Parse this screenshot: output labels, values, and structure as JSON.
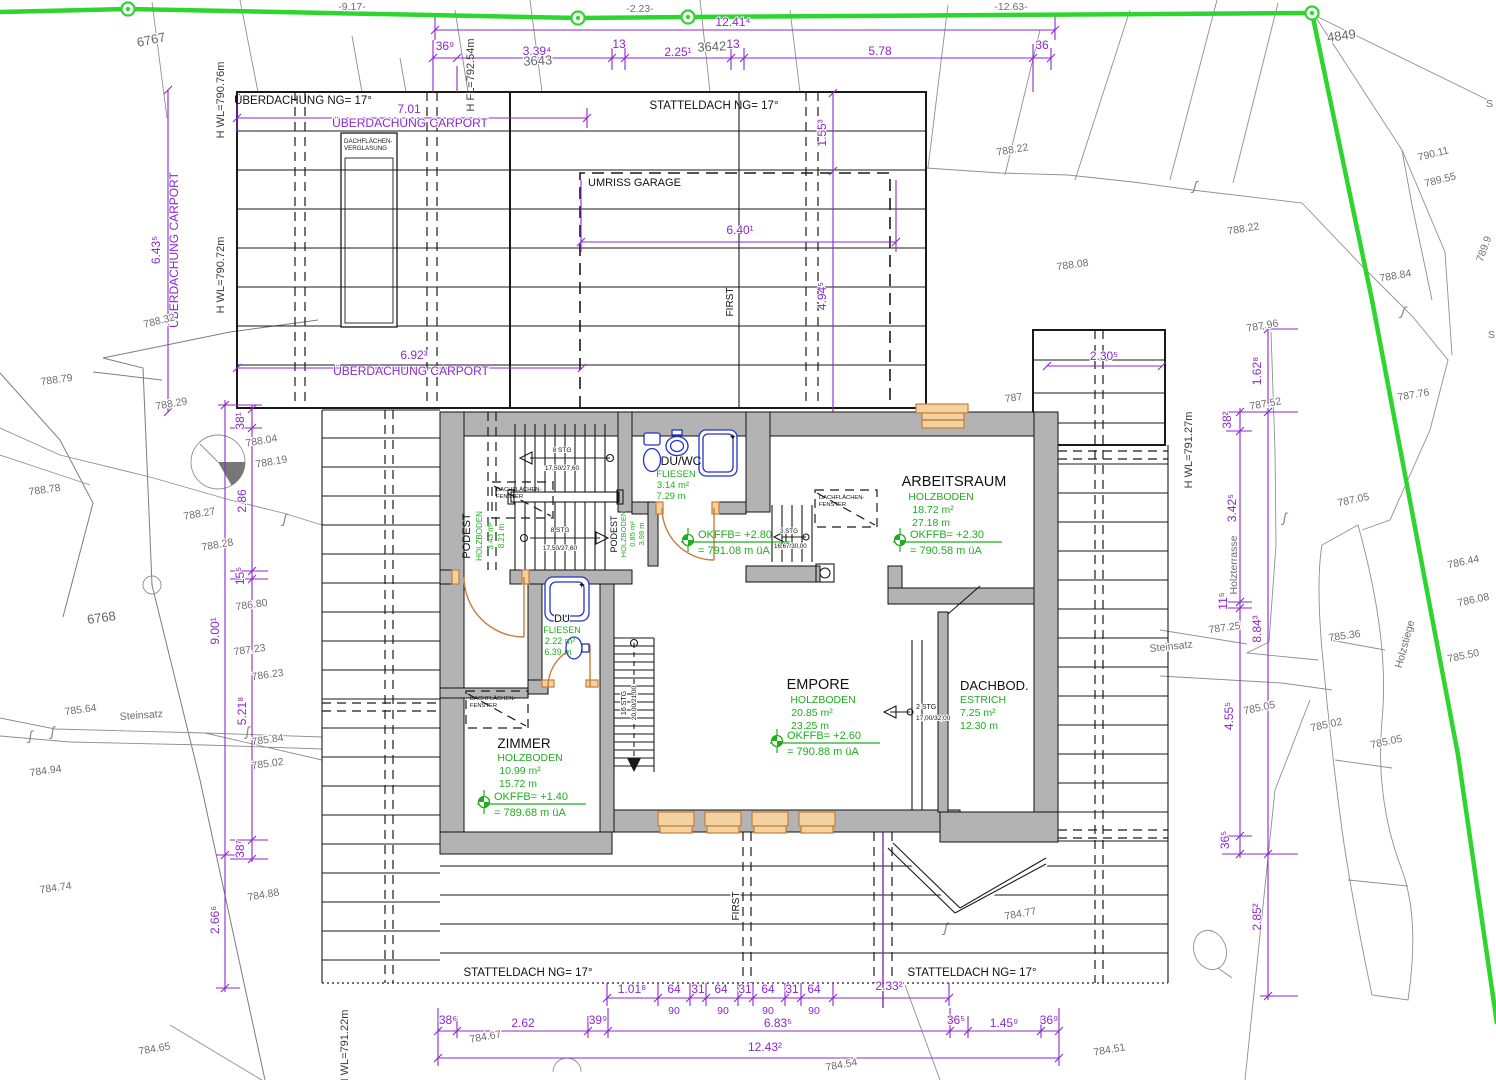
{
  "colors": {
    "dimension": "#8b28cc",
    "green_label": "#1fae1f",
    "boundary_green": "#2ed52e",
    "wall_gray": "#b3b3b3",
    "fixture_blue": "#2233cc",
    "door_orange": "#c87c3a",
    "survey_gray": "#8a8a8a"
  },
  "boundary": {
    "neg_917": "-9.17-",
    "neg_223": "-2.23-",
    "neg_1263": "-12.63-"
  },
  "parcels": {
    "p6767": "6767",
    "p3642": "3642",
    "p3643": "3643",
    "p4849": "4849",
    "p6768": "6768"
  },
  "hmarks": {
    "wl_79076": "H WL=790.76m",
    "fl_79254": "H FL=792.54m",
    "wl_79072": "H WL=790.72m",
    "wl_79127": "H WL=791.27m",
    "wl_79122": "H WL=791.22m"
  },
  "carport": {
    "title": "ÜBERDACHUNG  NG= 17°",
    "label1": "ÜBERDACHUNG CARPORT",
    "label2": "ÜBERDACHUNG CARPORT",
    "label3": "ÜBERDACHUNG CARPORT",
    "glaz1": "DACHFLÄCHEN-",
    "glaz2": "VERGLASUNG",
    "dim_701": "7.01",
    "dim_692": "6.92³",
    "dim_643": "6.43⁵"
  },
  "garage": {
    "title": "STATTELDACH  NG= 17°",
    "umriss": "UMRISS GARAGE",
    "first": "FIRST",
    "dim_640": "6.40¹",
    "dim_155": "1.55³",
    "dim_494": "4.94⁵"
  },
  "roofplan": {
    "label_bl": "STATTELDACH  NG= 17°",
    "label_br": "STATTELDACH  NG= 17°",
    "first": "FIRST",
    "dim_230": "2.30⁵"
  },
  "dims": {
    "top_total": "12.41⁴",
    "top": [
      "36⁹",
      "3.39⁴",
      "13",
      "2.25¹",
      "13",
      "5.78",
      "36"
    ],
    "left": [
      "38¹",
      "2.86",
      "15⁵",
      "9.00¹",
      "5.21⁸",
      "38⁷",
      "2.66⁶"
    ],
    "right": [
      "1.62⁸",
      "38²",
      "3.42⁵",
      "11⁵",
      "8.84³",
      "4.55⁵",
      "36⁵",
      "2.85²"
    ],
    "bottom_a": [
      "1.01⁸",
      "64",
      "31",
      "64",
      "31",
      "64",
      "31",
      "64",
      "2.33²"
    ],
    "bottom_90": [
      "90",
      "90",
      "90",
      "90"
    ],
    "bottom_b": [
      "38⁶",
      "2.62",
      "39⁹",
      "6.83⁵",
      "36⁵",
      "1.45⁹",
      "36⁹"
    ],
    "bottom_total": "12.43²"
  },
  "rooms": {
    "duwc": {
      "name": "DU/WC",
      "finish": "FLIESEN",
      "area": "3.14 m²",
      "perim": "7.29 m"
    },
    "arbeitsraum": {
      "name": "ARBEITSRAUM",
      "finish": "HOLZBODEN",
      "area": "18.72 m²",
      "perim": "27.18 m",
      "okffb": "OKFFB= +2.30",
      "okffb2": "= 790.58 m üA"
    },
    "podest1": {
      "name": "PODEST",
      "finish": "HOLZBODEN",
      "area": "3.43 m²",
      "perim": "8.21 m"
    },
    "podest2": {
      "name": "PODEST",
      "finish": "HOLZBODEN",
      "area": "0.85 m²",
      "perim": "3.98 m"
    },
    "flur": {
      "okffb": "OKFFB= +2.80",
      "okffb2": "= 791.08 m üA"
    },
    "du": {
      "name": "DU",
      "finish": "FLIESEN",
      "area": "2.22 m²",
      "perim": "6.39 m"
    },
    "zimmer": {
      "name": "ZIMMER",
      "finish": "HOLZBODEN",
      "area": "10.99 m²",
      "perim": "15.72 m",
      "okffb": "OKFFB= +1.40",
      "okffb2": "= 789.68 m üA"
    },
    "empore": {
      "name": "EMPORE",
      "finish": "HOLZBODEN",
      "area": "20.85 m²",
      "perim": "23.25 m",
      "okffb": "OKFFB= +2.60",
      "okffb2": "= 790.88 m üA"
    },
    "dachboden": {
      "name": "DACHBOD.",
      "finish": "ESTRICH",
      "area": "7.25 m²",
      "perim": "12.30 m"
    }
  },
  "stairs": {
    "s1a": "8 STG",
    "s1b": "17,50/27,60",
    "s2a": "8 STG",
    "s2b": "17,50/27,60",
    "s3a": "3 STG",
    "s3b": "16,67/30,00",
    "s4a": "16 STG",
    "s4b": "20,00/21,00",
    "s5a": "2 STG",
    "s5b": "17,00/32,00"
  },
  "skylight": {
    "line1": "DACHFLÄCHEN-",
    "line2": "FENSTER"
  },
  "site": {
    "steinsatz_left": "Steinsatz",
    "steinsatz_right": "Steinsatz",
    "holzterrasse": "Holzterrasse",
    "holzstiege": "Holzstiege",
    "s_partial_1": "S",
    "s_partial_2": "S",
    "elev": [
      "788.22",
      "788.22",
      "788.08",
      "788.84",
      "790.11",
      "789.55",
      "789.9",
      "787.76",
      "787.05",
      "786.44",
      "786.08",
      "785.50",
      "785.36",
      "787.25",
      "787.96",
      "787.52",
      "787",
      "788.79",
      "788.29",
      "788.32",
      "788.04",
      "788.19",
      "788.78",
      "788.27",
      "788.28",
      "786.80",
      "787.23",
      "786.23",
      "785.84",
      "785.02",
      "785.64",
      "784.94",
      "784.74",
      "784.88",
      "784.65",
      "784.67",
      "784.54",
      "784.51",
      "784.77",
      "785.05",
      "785.02",
      "785.05"
    ]
  }
}
